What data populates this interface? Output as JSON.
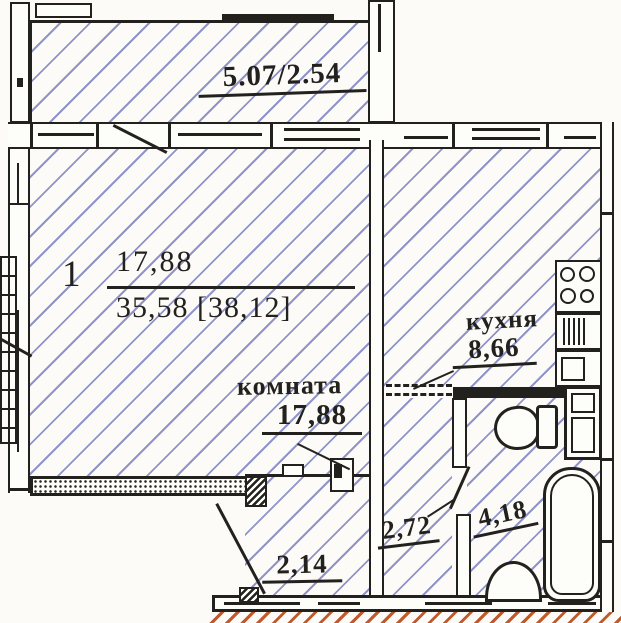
{
  "meta": {
    "drawing_type": "apartment floor plan (scanned)"
  },
  "colors": {
    "paper": "#fcfbf7",
    "ink": "#23211d",
    "hatch_blue": "#9094c9",
    "hatch_orange": "#c05a2a"
  },
  "balcony": {
    "dim_label": "5.07/2.54"
  },
  "unit": {
    "number": "1",
    "living_area": "17,88",
    "total_area": "35,58 [38,12]"
  },
  "living_room": {
    "name": "комната",
    "area": "17,88"
  },
  "kitchen": {
    "name": "кухня",
    "area": "8,66"
  },
  "hall": {
    "area": "2,72"
  },
  "bathroom": {
    "area": "4,18"
  },
  "corridor": {
    "area": "2,14"
  },
  "fixtures": {
    "stove": "stove-icon",
    "kitchen_sink": "kitchen-sink-icon",
    "counter": "kitchen-counter-icon",
    "toilet": "toilet-icon",
    "water_heater": "water-heater-icon",
    "bathtub": "bathtub-icon",
    "washbasin": "washbasin-icon"
  }
}
